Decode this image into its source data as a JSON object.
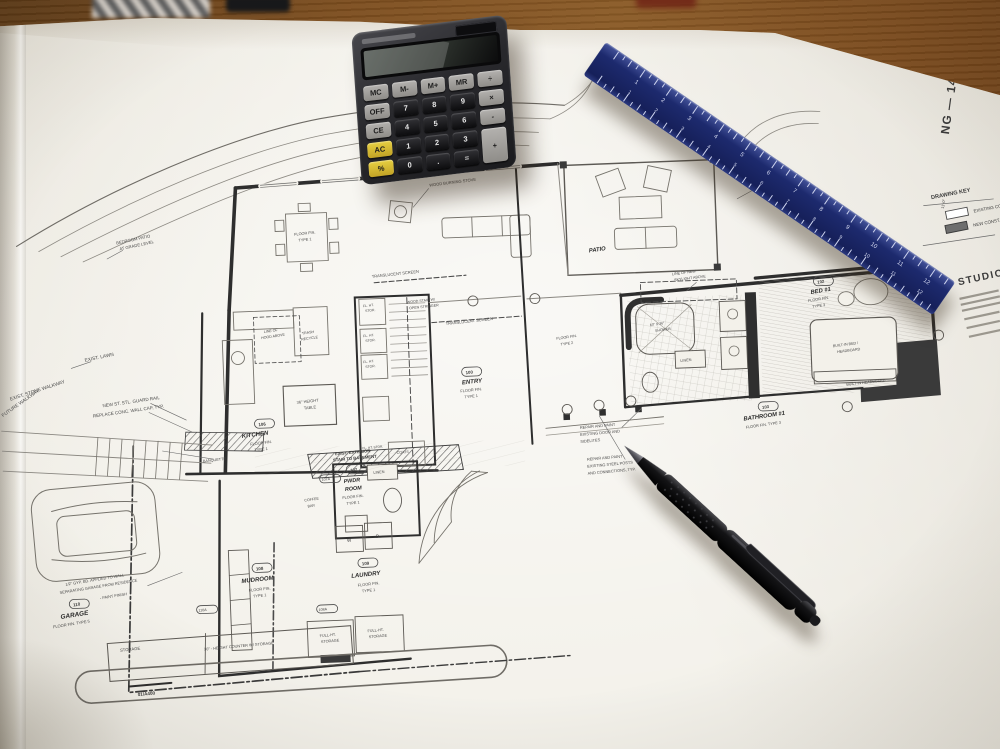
{
  "sheet": {
    "edge_title": "NG — 14 OCT 2025",
    "section_marker": "01/A400",
    "drawing_key": {
      "title": "DRAWING KEY",
      "existing": "EXISTING CONST.",
      "new": "NEW CONST."
    },
    "title_block": {
      "firm": "STUDIO"
    }
  },
  "rooms": {
    "kitchen": {
      "num": "106",
      "name": "KITCHEN",
      "floor": "FLOOR FIN.",
      "type": "TYPE 1"
    },
    "entry": {
      "num": "100",
      "name": "ENTRY",
      "floor": "FLOOR FIN.",
      "type": "TYPE 1"
    },
    "patio": {
      "name": "PATIO"
    },
    "pwdr": {
      "num": "107",
      "name1": "PWDR",
      "name2": "ROOM",
      "floor": "FLOOR FIN.",
      "type": "TYPE 1"
    },
    "mudroom": {
      "num": "108",
      "name": "MUDROOM",
      "floor": "FLOOR FIN.",
      "type": "TYPE 1"
    },
    "laundry": {
      "num": "109",
      "name": "LAUNDRY",
      "floor": "FLOOR FIN.",
      "type": "TYPE 1"
    },
    "garage": {
      "num": "110",
      "name": "GARAGE",
      "floor": "FLOOR FIN. TYPE 5"
    },
    "bed1": {
      "num": "102",
      "name": "BED #1",
      "floor": "FLOOR FIN.",
      "type": "TYPE 3"
    },
    "bath1": {
      "num": "103",
      "name": "BATHROOM #1",
      "floor": "FLOOR FIN. TYPE 3"
    }
  },
  "labels": {
    "exist_lawn": "EXIST. LAWN",
    "future_walkway": "FUTURE WALKWAY",
    "stone_walkway": "EXIST. STONE WALKWAY",
    "guard_rail": "NEW ST. STL. GUARD RAIL",
    "wall_cap": "REPLACE CONC. WALL CAP, TYP.",
    "basement_stair1": "EXIST. EXTERIOR",
    "basement_stair2": "STAIR TO BASEMENT",
    "bedroom_patio1": "BEDROOM PATIO",
    "bedroom_patio2": "AT GRADE LEVEL",
    "wood_stove": "WOOD BURNING STOVE",
    "screen": "TRANSLUCENT SCREEN",
    "stair1": "WOOD STAIR W/",
    "stair2": "OPEN STRINGER",
    "flht1": "FL. HT.",
    "flht2": "STOR.",
    "flht_line": "FL. HT. STOR.",
    "coats": "COATS",
    "linen": "LINEN",
    "coffee1": "COFFEE",
    "coffee2": "BAR",
    "banquette": "BANQUETTE",
    "high_table1": "36\" HEIGHT",
    "high_table2": "TABLE",
    "counter30": "30\" - HEIGHT COUNTER W/ STORAGE",
    "fullht1": "FULL-HT.",
    "fullht2": "STORAGE",
    "storage": "STORAGE",
    "washer": "W",
    "dryer": "D",
    "shower1": "60\" X 36\"",
    "shower2": "SHOWER",
    "skylight1": "LINE OF NEW",
    "skylight2": "SKYLIGHT ABOVE",
    "hood1": "LINE OF",
    "hood2": "HOOD ABOVE",
    "trash1": "TRASH",
    "trash2": "RECYCLE",
    "builtin_bed1": "BUILT-IN BED /",
    "builtin_bed2": "HEADBOARD",
    "builtin_hb": "BUILT-IN HEADBOARD",
    "repair_door1": "REPAIR AND PAINT",
    "repair_door2": "EXISTING DOOR AND",
    "repair_door3": "SIDELITES",
    "repair_steel1": "REPAIR AND PAINT",
    "repair_steel2": "EXISTING STEEL POSTS",
    "repair_steel3": "AND CONNECTIONS, TYP.",
    "gyp1": "1/2\" GYP. BD. APPLIED TO WALL",
    "gyp2": "SEPARATING GARAGE FROM RESIDENCE",
    "gyp3": "- PAINT FINISH",
    "floor_fin1a": "FLOOR FIN.",
    "floor_fin1b": "TYPE 1",
    "floor_fin2a": "FLOOR FIN.",
    "floor_fin2b": "TYPE 2",
    "dim1": "11'-0\"",
    "tag107a": "107A",
    "tag108a": "108A",
    "tag110a": "110A"
  },
  "calculator": {
    "display": "",
    "keys": [
      {
        "label": "MC",
        "type": "g"
      },
      {
        "label": "M-",
        "type": "g"
      },
      {
        "label": "M+",
        "type": "g"
      },
      {
        "label": "MR",
        "type": "g"
      },
      {
        "label": "÷",
        "type": "g"
      },
      {
        "label": "OFF",
        "type": "g"
      },
      {
        "label": "7",
        "type": "d"
      },
      {
        "label": "8",
        "type": "d"
      },
      {
        "label": "9",
        "type": "d"
      },
      {
        "label": "×",
        "type": "g"
      },
      {
        "label": "CE",
        "type": "g"
      },
      {
        "label": "4",
        "type": "d"
      },
      {
        "label": "5",
        "type": "d"
      },
      {
        "label": "6",
        "type": "d"
      },
      {
        "label": "-",
        "type": "g"
      },
      {
        "label": "AC",
        "type": "y"
      },
      {
        "label": "1",
        "type": "d"
      },
      {
        "label": "2",
        "type": "d"
      },
      {
        "label": "3",
        "type": "d"
      },
      {
        "label": "+",
        "type": "t"
      },
      {
        "label": "%",
        "type": "y"
      },
      {
        "label": "0",
        "type": "d"
      },
      {
        "label": ".",
        "type": "d"
      },
      {
        "label": "=",
        "type": "d"
      }
    ]
  },
  "ruler": {
    "unit_numbers": [
      1,
      2,
      3,
      4,
      5,
      6,
      7,
      8,
      9,
      10,
      11,
      12
    ]
  }
}
